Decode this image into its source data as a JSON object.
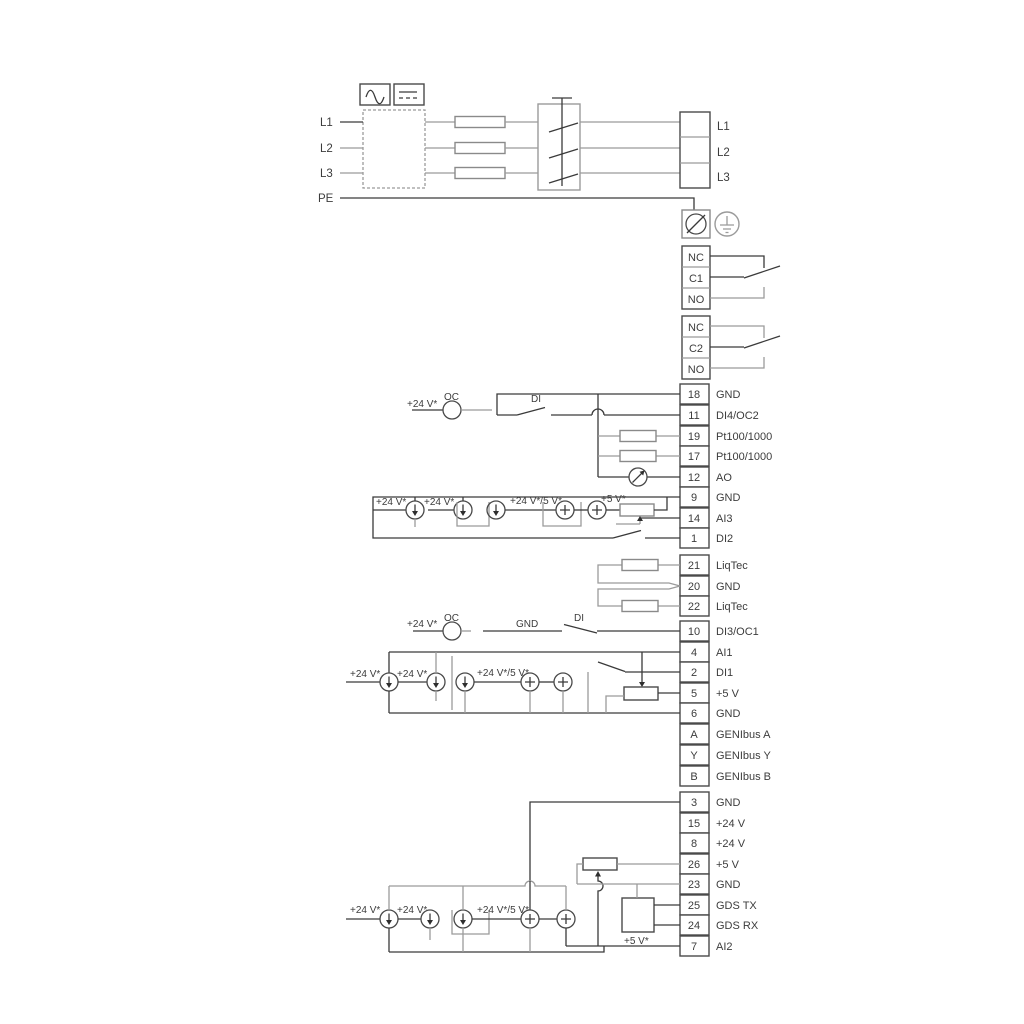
{
  "power": {
    "l1": "L1",
    "l2": "L2",
    "l3": "L3",
    "pe": "PE",
    "out_l1": "L1",
    "out_l2": "L2",
    "out_l3": "L3"
  },
  "relay1": {
    "nc": "NC",
    "c": "C1",
    "no": "NO"
  },
  "relay2": {
    "nc": "NC",
    "c": "C2",
    "no": "NO"
  },
  "terminals": {
    "g1": [
      {
        "no": "18",
        "label": "GND"
      },
      {
        "no": "11",
        "label": "DI4/OC2"
      },
      {
        "no": "19",
        "label": "Pt100/1000"
      },
      {
        "no": "17",
        "label": "Pt100/1000"
      },
      {
        "no": "12",
        "label": "AO"
      },
      {
        "no": "9",
        "label": "GND"
      },
      {
        "no": "14",
        "label": "AI3"
      },
      {
        "no": "1",
        "label": "DI2"
      }
    ],
    "g2": [
      {
        "no": "21",
        "label": "LiqTec"
      },
      {
        "no": "20",
        "label": "GND"
      },
      {
        "no": "22",
        "label": "LiqTec"
      }
    ],
    "g3": [
      {
        "no": "10",
        "label": "DI3/OC1"
      },
      {
        "no": "4",
        "label": "AI1"
      },
      {
        "no": "2",
        "label": "DI1"
      },
      {
        "no": "5",
        "label": "+5 V"
      },
      {
        "no": "6",
        "label": "GND"
      },
      {
        "no": "A",
        "label": "GENIbus A"
      },
      {
        "no": "Y",
        "label": "GENIbus Y"
      },
      {
        "no": "B",
        "label": "GENIbus B"
      }
    ],
    "g4": [
      {
        "no": "3",
        "label": "GND"
      },
      {
        "no": "15",
        "label": "+24 V"
      },
      {
        "no": "8",
        "label": "+24 V"
      },
      {
        "no": "26",
        "label": "+5 V"
      },
      {
        "no": "23",
        "label": "GND"
      },
      {
        "no": "25",
        "label": "GDS TX"
      },
      {
        "no": "24",
        "label": "GDS RX"
      },
      {
        "no": "7",
        "label": "AI2"
      }
    ]
  },
  "ann": {
    "di4_v24": "+24 V*",
    "di4_oc": "OC",
    "di4_di": "DI",
    "ai3_v24a": "+24 V*",
    "ai3_v24b": "+24 V*",
    "ai3_v245": "+24 V*/5 V*",
    "ai3_v5": "+5 V*",
    "di3_v24": "+24 V*",
    "di3_oc": "OC",
    "di3_gnd": "GND",
    "di3_di": "DI",
    "ai1_v24a": "+24 V*",
    "ai1_v24b": "+24 V*",
    "ai1_v245": "+24 V*/5 V*",
    "ai2_v24a": "+24 V*",
    "ai2_v24b": "+24 V*",
    "ai2_v245": "+24 V*/5 V*",
    "gds_v5": "+5 V*"
  },
  "colors": {
    "line": "#3a3a3a",
    "gray_line": "#9b9b9b",
    "text": "#3c3c3c",
    "background": "#ffffff"
  }
}
